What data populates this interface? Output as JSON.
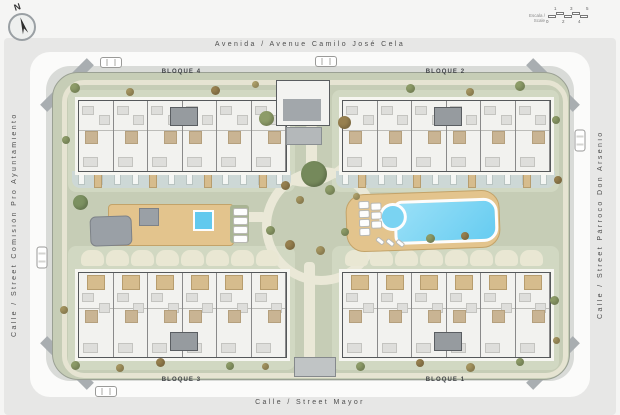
{
  "compass": {
    "label": "N"
  },
  "scale_bar": {
    "label": "Escala / Scale",
    "ticks": [
      "0",
      "1",
      "2",
      "3",
      "4",
      "5"
    ]
  },
  "streets": {
    "top": "Avenida / Avenue Camilo José Cela",
    "bottom": "Calle / Street Mayor",
    "left": "Calle / Street Comisión Pro Ayuntamiento",
    "right": "Calle / Street Párroco Don Arsenio"
  },
  "blocks": [
    {
      "label": "BLOQUE 4"
    },
    {
      "label": "BLOQUE 2"
    },
    {
      "label": "BLOQUE 3"
    },
    {
      "label": "BLOQUE 1"
    }
  ],
  "colors": {
    "lawn": "#c6cdb6",
    "path": "#eae8d7",
    "pool": "#74d0f4",
    "deck": "#e3c48d",
    "terrace_strip": "#cdd8d7",
    "building": "#f2f2ef",
    "street": "#e7e7e6",
    "road": "#fbfbfa"
  }
}
